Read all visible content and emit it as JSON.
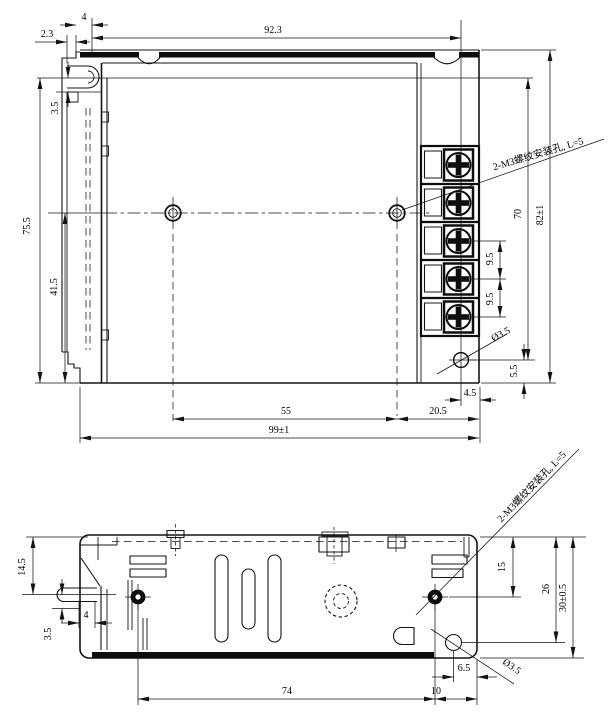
{
  "drawing": {
    "kind": "enclosure-dimension-drawing",
    "views": {
      "top": {
        "dims": {
          "d4": "4",
          "d2_3": "2.3",
          "d92_3": "92.3",
          "d3_5": "3.5",
          "d75_5": "75.5",
          "d41_5": "41.5",
          "d82": "82±1",
          "d70": "70",
          "d9_5a": "9.5",
          "d9_5b": "9.5",
          "dia3_5": "Ø3.5",
          "d5_5": "5.5",
          "d4_5": "4.5",
          "d20_5": "20.5",
          "d55": "55",
          "d99": "99±1",
          "note": "2-M3螺纹安装孔, L=5"
        }
      },
      "side": {
        "dims": {
          "d14_5": "14.5",
          "d3_5": "3.5",
          "d4": "4",
          "d15": "15",
          "d26": "26",
          "d30": "30±0.5",
          "d6_5": "6.5",
          "d10": "10",
          "d74": "74",
          "dia3_5": "Ø3.5",
          "note": "2-M3螺纹安装孔, L=5"
        }
      }
    }
  }
}
